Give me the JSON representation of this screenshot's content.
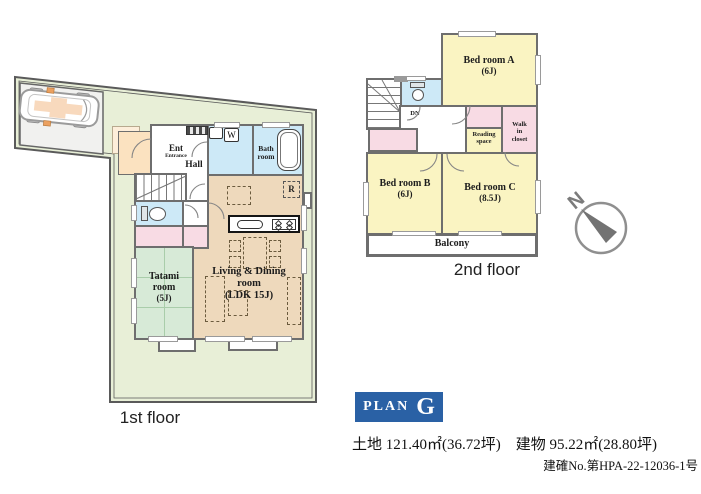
{
  "plan_badge": {
    "label": "PLAN",
    "letter": "G"
  },
  "details": {
    "area_line": "土地 121.40㎡(36.72坪)　建物 95.22㎡(28.80坪)",
    "permit_line": "建確No.第HPA-22-12036-1号"
  },
  "compass": {
    "north": "N"
  },
  "floor1": {
    "caption": "1st floor",
    "ent": "Ent",
    "ent_sub": "Entrance",
    "hall": "Hall",
    "washer": "W",
    "bath1": "Bath",
    "bath2": "room",
    "tatami1": "Tatami",
    "tatami2": "room",
    "tatami3": "(5J)",
    "ldk1": "Living & Dining",
    "ldk2": "room",
    "ldk3": "(LDK 15J)",
    "fridge": "R"
  },
  "floor2": {
    "caption": "2nd floor",
    "bedA1": "Bed room A",
    "bedA2": "(6J)",
    "bedB1": "Bed room B",
    "bedB2": "(6J)",
    "bedC1": "Bed room C",
    "bedC2": "(8.5J)",
    "reading1": "Reading",
    "reading2": "space",
    "wic1": "Walk",
    "wic2": "in",
    "wic3": "closet",
    "balcony": "Balcony",
    "down": "DN"
  },
  "colors": {
    "lot_green": "#e8efd7",
    "room_tan": "#eed9bc",
    "room_yellow": "#faf4c2",
    "room_pink": "#f8dbe4",
    "room_blue": "#cde9f7",
    "room_green": "#d7ead7",
    "porch_orange": "#fbe2c0",
    "wall_gray": "#6e6e6e",
    "plan_blue": "#2a61a5"
  }
}
